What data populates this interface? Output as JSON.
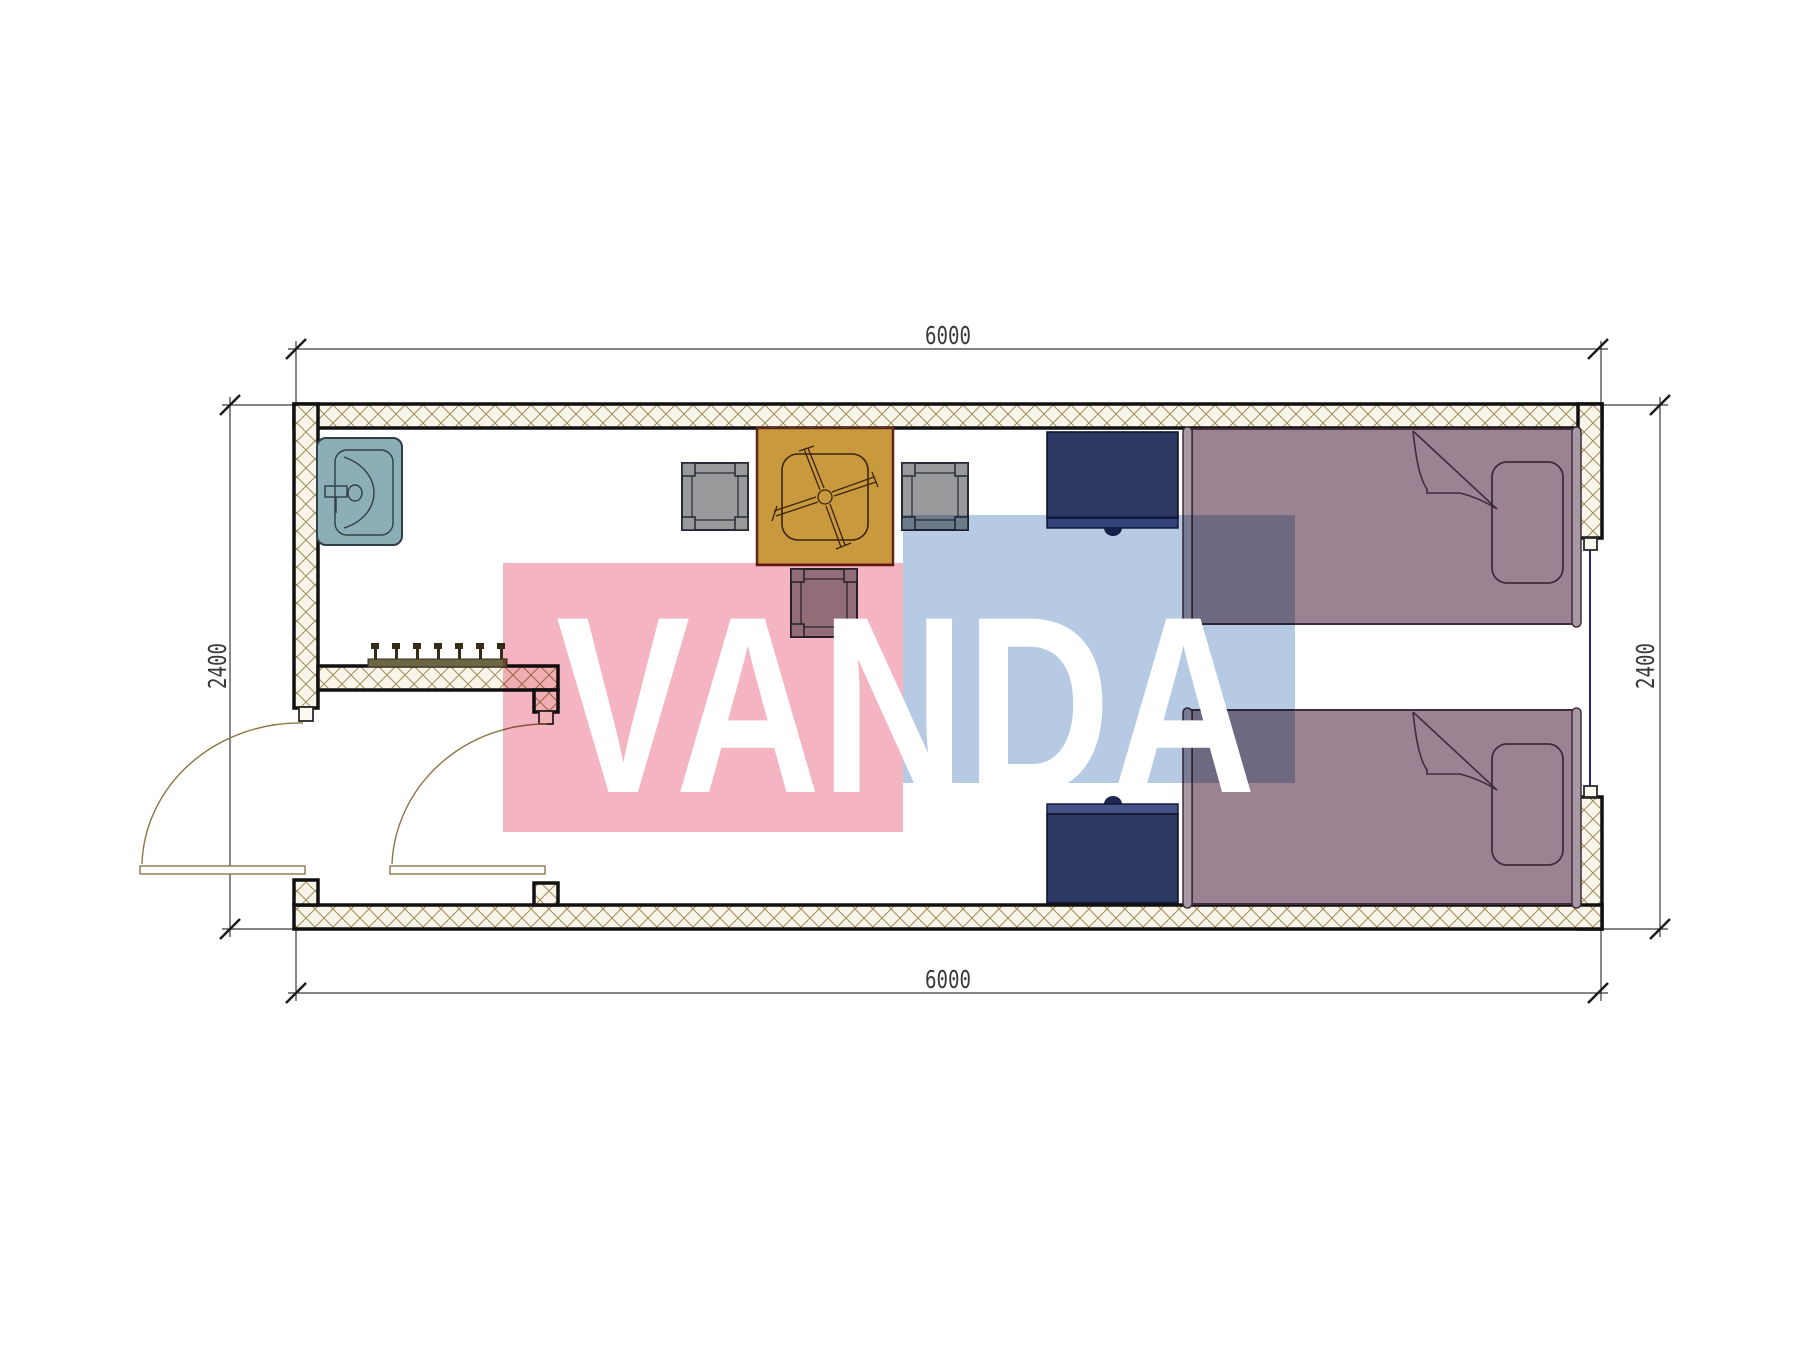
{
  "title": "container-room-floor-plan",
  "dimensions": {
    "top": "6000",
    "bottom": "6000",
    "left": "2400",
    "right": "2400"
  },
  "watermark": {
    "text": "VANDA",
    "pink_color": "#f5b4c2",
    "blue_color": "#b6cbe3",
    "text_color": "#ffffff"
  },
  "colors": {
    "wall_fill": "#faf5ea",
    "wall_hatch_line": "#a08e58",
    "wall_edge": "#111111",
    "sink": "#8caeb6",
    "sink_stroke": "#2f4046",
    "coat_rack": "#6e6544",
    "table": "#c9993e",
    "table_stroke": "#5e2717",
    "chair": "#98999b",
    "chair_stroke": "#262b33",
    "nightstand": "#2c3963",
    "nightstand_rail": "#45528a",
    "bed": "#9b8391",
    "bed_board": "#a89aa5",
    "bed_stroke": "#402c3a",
    "window_line": "#24247e",
    "door": "#8a7848",
    "dimension": "#3a3a3a"
  },
  "plan_elements": [
    "exterior-walls",
    "entry-vestibule-wall",
    "sink",
    "coat-rack",
    "square-table-with-cross-base",
    "chair-left",
    "chair-right",
    "chair-bottom",
    "nightstand-top",
    "nightstand-bottom",
    "single-bed-top",
    "single-bed-bottom",
    "swing-door-left",
    "swing-door-inner",
    "window-right"
  ]
}
